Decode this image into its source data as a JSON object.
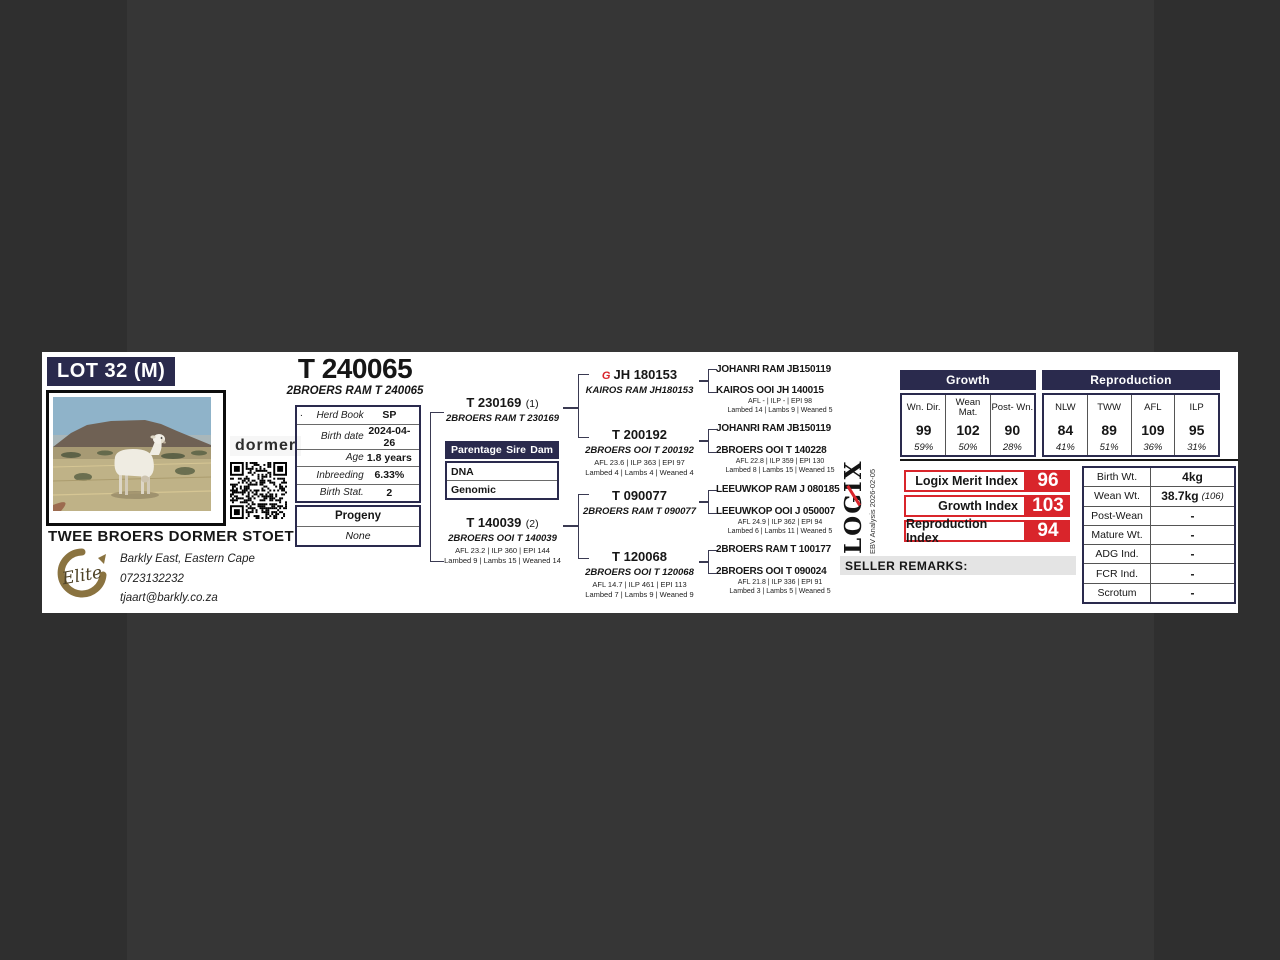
{
  "lot": {
    "label": "LOT 32 (M)"
  },
  "breeder": {
    "name": "TWEE BROERS DORMER STOET",
    "location": "Barkly East, Eastern Cape",
    "phone": "0723132232",
    "email": "tjaart@barkly.co.za",
    "breed_logo": "dormer",
    "elite_label": "Elite"
  },
  "animal": {
    "id": "T 240065",
    "full_name": "2BROERS RAM T 240065"
  },
  "herd_info": {
    "marker": ".",
    "rows": [
      {
        "label": "Herd Book",
        "value": "SP"
      },
      {
        "label": "Birth date",
        "value": "2024-04-26"
      },
      {
        "label": "Age",
        "value": "1.8 years"
      },
      {
        "label": "Inbreeding",
        "value": "6.33%"
      },
      {
        "label": "Birth Stat.",
        "value": "2"
      }
    ]
  },
  "progeny": {
    "title": "Progeny",
    "value": "None"
  },
  "parentage": {
    "columns": [
      "Parentage",
      "Sire",
      "Dam"
    ],
    "rows": [
      "DNA",
      "Genomic"
    ]
  },
  "pedigree": {
    "sire": {
      "id": "T 230169",
      "tag": "(1)",
      "name": "2BROERS RAM T 230169"
    },
    "dam": {
      "id": "T 140039",
      "tag": "(2)",
      "name": "2BROERS OOI T 140039",
      "stats1": "AFL 23.2 | ILP 360 | EPI 144",
      "stats2": "Lambed 9 | Lambs 15 | Weaned 14"
    },
    "grandparents": [
      {
        "id": "JH 180153",
        "name": "KAIROS RAM JH180153",
        "icon": "kairos-stud-icon",
        "icon_glyph": "G"
      },
      {
        "id": "T 200192",
        "name": "2BROERS OOI T 200192",
        "stats1": "AFL 23.6 | ILP 363 | EPI 97",
        "stats2": "Lambed 4 | Lambs 4 | Weaned 4"
      },
      {
        "id": "T 090077",
        "name": "2BROERS RAM T 090077"
      },
      {
        "id": "T 120068",
        "name": "2BROERS OOI T 120068",
        "stats1": "AFL 14.7 | ILP 461 | EPI 113",
        "stats2": "Lambed 7 | Lambs 9 | Weaned 9"
      }
    ],
    "great_grandparents": [
      {
        "name": "JOHANRI RAM JB150119"
      },
      {
        "name": "KAIROS OOI JH 140015",
        "stats1": "AFL - | ILP - | EPI 98",
        "stats2": "Lambed 14 | Lambs 9 | Weaned 5"
      },
      {
        "name": "JOHANRI RAM JB150119"
      },
      {
        "name": "2BROERS OOI T 140228",
        "stats1": "AFL 22.8 | ILP 359 | EPI 130",
        "stats2": "Lambed 8 | Lambs 15 | Weaned 15"
      },
      {
        "name": "LEEUWKOP RAM J 080185"
      },
      {
        "name": "LEEUWKOP OOI J 050007",
        "stats1": "AFL 24.9 | ILP 362 | EPI 94",
        "stats2": "Lambed 6 | Lambs 11 | Weaned 5"
      },
      {
        "name": "2BROERS RAM T 100177"
      },
      {
        "name": "2BROERS OOI T 090024",
        "stats1": "AFL 21.8 | ILP 336 | EPI 91",
        "stats2": "Lambed 3 | Lambs 5 | Weaned 5"
      }
    ]
  },
  "ebv": {
    "growth": {
      "title": "Growth",
      "columns": [
        {
          "label": "Wn. Dir.",
          "value": "99",
          "acc": "59%"
        },
        {
          "label": "Wean Mat.",
          "value": "102",
          "acc": "50%"
        },
        {
          "label": "Post- Wn.",
          "value": "90",
          "acc": "28%"
        }
      ]
    },
    "reproduction": {
      "title": "Reproduction",
      "columns": [
        {
          "label": "NLW",
          "value": "84",
          "acc": "41%"
        },
        {
          "label": "TWW",
          "value": "89",
          "acc": "51%"
        },
        {
          "label": "AFL",
          "value": "109",
          "acc": "36%"
        },
        {
          "label": "ILP",
          "value": "95",
          "acc": "31%"
        }
      ]
    }
  },
  "logix": {
    "logo": "LOGIX",
    "analysis": "EBV Analysis 2026-02-05",
    "indices": [
      {
        "label": "Logix Merit Index",
        "value": "96"
      },
      {
        "label": "Growth Index",
        "value": "103"
      },
      {
        "label": "Reproduction Index",
        "value": "94"
      }
    ]
  },
  "seller_remarks": {
    "label": "SELLER REMARKS:"
  },
  "weights": {
    "rows": [
      {
        "label": "Birth Wt.",
        "value": "4kg"
      },
      {
        "label": "Wean Wt.",
        "value": "38.7kg",
        "note": "(106)"
      },
      {
        "label": "Post-Wean",
        "value": "-"
      },
      {
        "label": "Mature Wt.",
        "value": "-"
      },
      {
        "label": "ADG Ind.",
        "value": "-"
      },
      {
        "label": "FCR Ind.",
        "value": "-"
      },
      {
        "label": "Scrotum",
        "value": "-"
      }
    ]
  },
  "colors": {
    "navy": "#2a2a4d",
    "red": "#d9252b",
    "background": "#2f2f2f",
    "card": "#ffffff"
  }
}
